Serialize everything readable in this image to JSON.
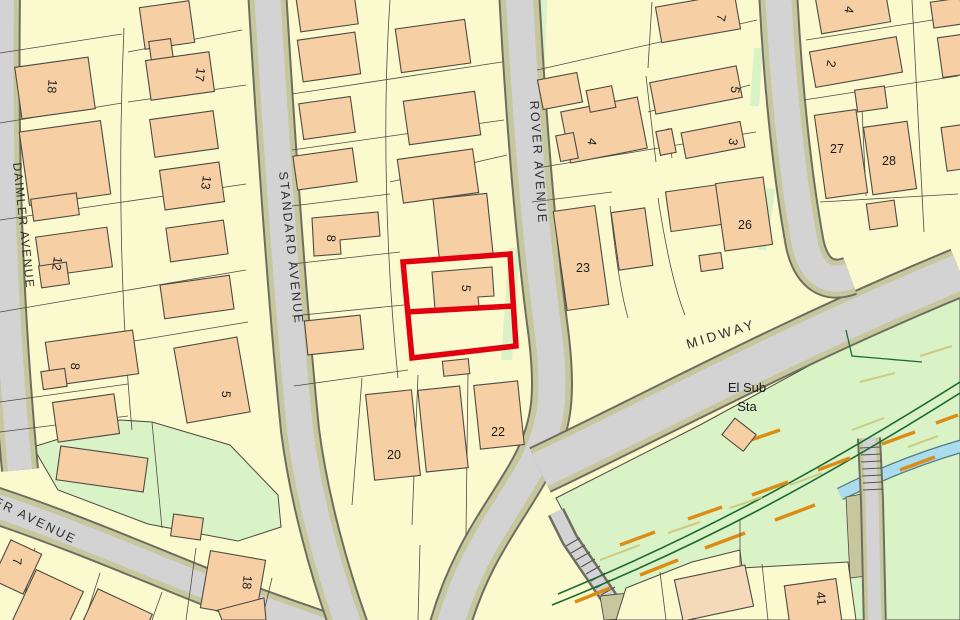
{
  "map": {
    "streets": {
      "daimler": "DAIMLER AVENUE",
      "standard": "STANDARD AVENUE",
      "rover": "ROVER AVENUE",
      "midway": "MIDWAY",
      "ter": "TER AVENUE"
    },
    "substation": {
      "line1": "El Sub",
      "line2": "Sta"
    },
    "houses": [
      "18",
      "17",
      "13",
      "12",
      "8",
      "5",
      "8",
      "5",
      "20",
      "22",
      "7",
      "5",
      "3",
      "4",
      "23",
      "26",
      "4",
      "2",
      "27",
      "28",
      "41",
      "18",
      "7"
    ],
    "colors": {
      "parcel": "#fbf9ce",
      "building": "#f6d0a4",
      "building_light": "#f5dab9",
      "line": "#4d4a43",
      "road": "#d3d3d3",
      "casing": "#c6c79c",
      "casing_edge": "#6e6e60",
      "green": "#d9f3c7",
      "hedge": "#1c6b33",
      "water": "#aadcee",
      "water_edge": "#557c85",
      "track_orange": "#dc8b13",
      "track_pale": "#cbcb82",
      "red": "#e2000f"
    }
  }
}
